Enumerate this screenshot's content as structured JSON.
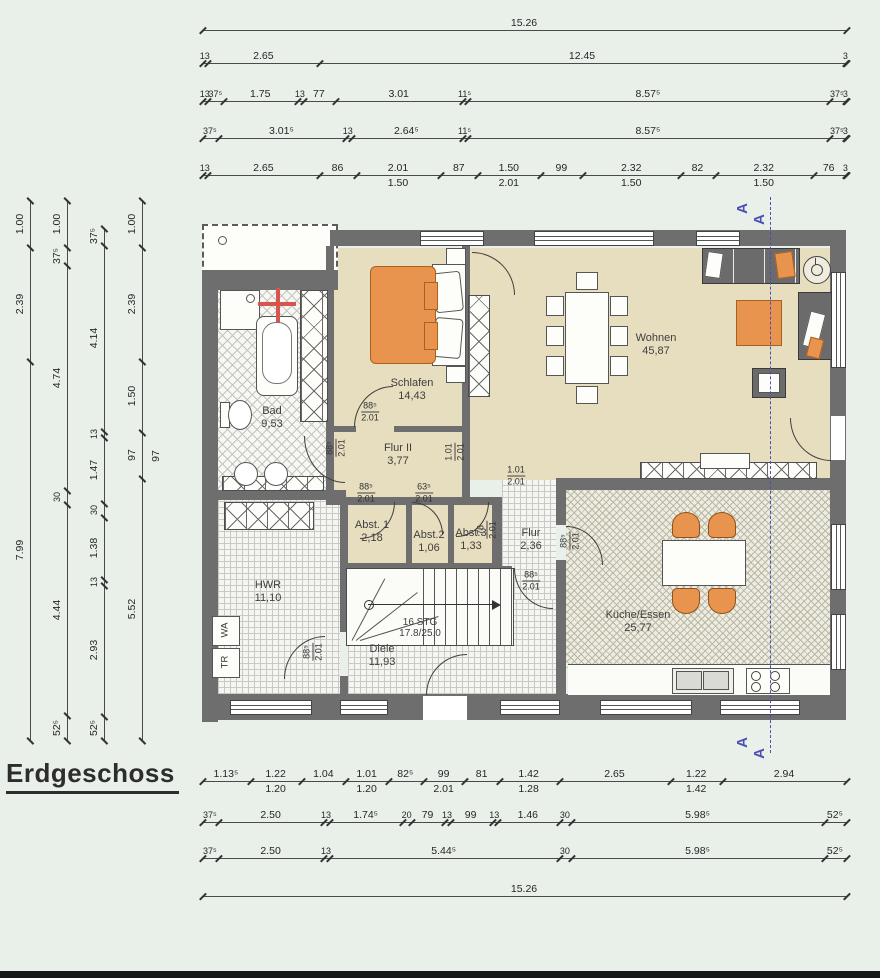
{
  "title": "Erdgeschoss",
  "section": {
    "letter": "A"
  },
  "laundry": [
    "WA",
    "TR"
  ],
  "stairs": {
    "l1": "16 STG",
    "l2": "17.8/25.0"
  },
  "colors": {
    "wall": "#6e6e6e",
    "floor_beige": "#e7ddbf",
    "accent_orange": "#e8944e",
    "section_blue": "#4a50b4"
  },
  "dims": {
    "top": [
      [
        "15.26"
      ],
      [
        "13",
        "2.65",
        "12.45",
        "3"
      ],
      [
        "13",
        "37⁵",
        "1.75",
        "13",
        "77",
        "3.01",
        "11⁵",
        "8.57⁵",
        "37⁵",
        "3"
      ],
      [
        "37⁵",
        "3.01⁵",
        "13",
        "2.64⁵",
        "11⁵",
        "8.57⁵",
        "37⁵",
        "3"
      ],
      [
        "13",
        "2.65",
        "86",
        "2.01",
        "87",
        "1.50",
        "99",
        "2.32",
        "82",
        "2.32",
        "76",
        "3"
      ]
    ],
    "top_subs_4": [
      {
        "i": 3,
        "t": "1.50"
      },
      {
        "i": 5,
        "t": "2.01"
      },
      {
        "i": 7,
        "t": "1.50"
      },
      {
        "i": 9,
        "t": "1.50"
      }
    ],
    "bottom": [
      [
        "1.13⁵",
        "1.22",
        "1.04",
        "1.01",
        "82⁵",
        "99",
        "81",
        "1.42",
        "2.65",
        "1.22",
        "2.94"
      ],
      [
        "37⁵",
        "2.50",
        "13",
        "1.74⁵",
        "20",
        "79",
        "13",
        "99",
        "13",
        "1.46",
        "30",
        "5.98⁵",
        "52⁵"
      ],
      [
        "37⁵",
        "2.50",
        "13",
        "5.44⁵",
        "30",
        "5.98⁵",
        "52⁵"
      ],
      [
        "15.26"
      ]
    ],
    "bottom_subs_0": [
      {
        "i": 1,
        "t": "1.20"
      },
      {
        "i": 3,
        "t": "1.20"
      },
      {
        "i": 5,
        "t": "2.01"
      },
      {
        "i": 7,
        "t": "1.28"
      },
      {
        "i": 9,
        "t": "1.42"
      }
    ],
    "left": [
      [
        "1.00",
        "2.39",
        "7.99"
      ],
      [
        "1.00",
        "37⁵",
        "4.74",
        "30",
        "4.44",
        "52⁵"
      ],
      [
        "37⁵",
        "4.14",
        "13",
        "1.47",
        "30",
        "1.38",
        "13",
        "2.93",
        "52⁵"
      ],
      [
        "1.00",
        "2.39",
        "1.50",
        "97",
        "5.52"
      ]
    ],
    "misc_labels": [
      {
        "t": "97",
        "x": 156,
        "y": 456,
        "rot": true
      }
    ]
  },
  "rooms": [
    {
      "name": "Bad",
      "area": "9,53",
      "x": 272,
      "y": 418
    },
    {
      "name": "Schlafen",
      "area": "14,43",
      "x": 412,
      "y": 390
    },
    {
      "name": "Flur II",
      "area": "3,77",
      "x": 398,
      "y": 455
    },
    {
      "name": "Wohnen",
      "area": "45,87",
      "x": 656,
      "y": 345
    },
    {
      "name": "Abst. 1",
      "area": "2,18",
      "x": 372,
      "y": 532
    },
    {
      "name": "Abst.2",
      "area": "1,06",
      "x": 429,
      "y": 542
    },
    {
      "name": "Abst.3",
      "area": "1,33",
      "x": 471,
      "y": 540
    },
    {
      "name": "Flur",
      "area": "2,36",
      "x": 531,
      "y": 540
    },
    {
      "name": "HWR",
      "area": "11,10",
      "x": 268,
      "y": 592
    },
    {
      "name": "Diele",
      "area": "11,93",
      "x": 382,
      "y": 656
    },
    {
      "name": "Küche/Essen",
      "area": "25,77",
      "x": 638,
      "y": 622
    }
  ],
  "door_labels": [
    {
      "w": "88⁵",
      "h": "2.01",
      "x": 370,
      "y": 412,
      "rot": false
    },
    {
      "w": "88⁵",
      "h": "2.01",
      "x": 336,
      "y": 448,
      "rot": true
    },
    {
      "w": "1.01",
      "h": "2.01",
      "x": 455,
      "y": 452,
      "rot": true
    },
    {
      "w": "1.01",
      "h": "2.01",
      "x": 516,
      "y": 476,
      "rot": false
    },
    {
      "w": "88⁵",
      "h": "2.01",
      "x": 366,
      "y": 493,
      "rot": false
    },
    {
      "w": "63⁵",
      "h": "2.01",
      "x": 424,
      "y": 493,
      "rot": false
    },
    {
      "w": "76",
      "h": "2.01",
      "x": 487,
      "y": 530,
      "rot": true
    },
    {
      "w": "88⁵",
      "h": "2.01",
      "x": 531,
      "y": 581,
      "rot": false
    },
    {
      "w": "88⁵",
      "h": "2.01",
      "x": 313,
      "y": 652,
      "rot": true
    },
    {
      "w": "88⁵",
      "h": "2.01",
      "x": 570,
      "y": 541,
      "rot": true
    }
  ]
}
